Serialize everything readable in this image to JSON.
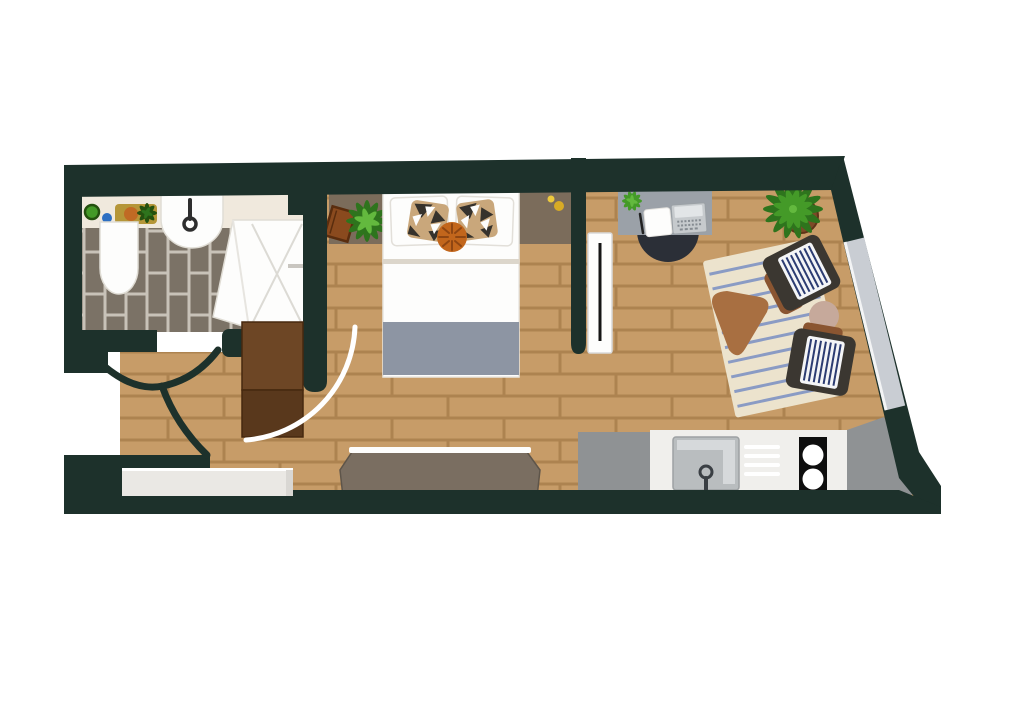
{
  "meta": {
    "title": "Studio apartment floor plan (top-down illustration)",
    "type": "floor-plan",
    "canvas_width": 1024,
    "canvas_height": 723
  },
  "colors": {
    "wall": "#1d312b",
    "floor_plank": "#c79c68",
    "floor_grout": "#ad8350",
    "bath_tile": "#7b7266",
    "bath_grout": "#c8c2b8",
    "counter_cream": "#f0e9dd",
    "white": "#fdfdfc",
    "fixture_stroke": "#e0ddd5",
    "headboard": "#7b6c5b",
    "blanket": "#8d95a3",
    "sheet_line": "#dcd6cb",
    "cushion_tan": "#c9a77b",
    "cushion_dark": "#36322c",
    "cushion_orange": "#c2661c",
    "cushion_orange_line": "#8f4612",
    "rug": "#ece3cd",
    "rug_stripe": "#8094c4",
    "chair_body": "#3b3731",
    "chair_pad": "#8a5531",
    "chair_cushion": "#f4f5f7",
    "chair_stripe": "#2c3c72",
    "coffee_table": "#a86f41",
    "side_table": "#c6a99b",
    "desk": "#9ba1a8",
    "laptop": "#c6cacd",
    "laptop_screen": "#e2e5e7",
    "laptop_key": "#858b91",
    "desk_chair": "#2b2f37",
    "radiator_line": "#151515",
    "window_glass": "#c9cdd3",
    "window_line": "#f3f4f5",
    "kitchen_gray": "#8f9294",
    "kitchen_white": "#f0efec",
    "sink_gray": "#b9bdbf",
    "sink_light": "#d7dadc",
    "faucet": "#3a3f44",
    "cooktop": "#0e0e0e",
    "bench": "#7a6e61",
    "bench_edge": "#5e554a",
    "mat": "#eae8e4",
    "door_top": "#6d4625",
    "door_bottom": "#59381c",
    "door_edge": "#46280f",
    "leaf_deep": "#24510f",
    "leaf_dark": "#2e741d",
    "leaf_mid": "#449a28",
    "leaf_light": "#63b93e",
    "pot": "#7c4a27",
    "pot_edge": "#5e3418",
    "tray": "#b59638",
    "tray_orange": "#c06a24",
    "dot_blue": "#2d6fc2",
    "dot_yellow_small": "#ecc93d",
    "dot_yellow_big": "#d8ab25",
    "book": "#8a4a1e",
    "book_edge": "#5a2d0e",
    "arc_white": "#ffffff"
  },
  "rooms": {
    "bathroom": {
      "items": [
        "vanity-counter",
        "toilet",
        "wash-basin",
        "shower-enclosure",
        "soap-pot",
        "blue-cup",
        "tray-with-plant",
        "tiled-floor"
      ]
    },
    "bedroom": {
      "items": [
        "double-bed",
        "pillow-left",
        "pillow-right",
        "patterned-cushion-left",
        "patterned-cushion-right",
        "round-orange-cushion",
        "gray-blanket",
        "headboard-shelf",
        "book",
        "plant-small",
        "wall-dots"
      ]
    },
    "workspace": {
      "items": [
        "desk",
        "laptop",
        "notepad",
        "pen",
        "desk-plant",
        "desk-chair"
      ]
    },
    "living": {
      "items": [
        "striped-rug",
        "armchair-top",
        "armchair-bottom",
        "coffee-table",
        "side-table",
        "large-potted-plant",
        "radiator",
        "window"
      ]
    },
    "kitchen": {
      "items": [
        "counter-gray-left",
        "counter-white",
        "kitchen-sink",
        "faucet",
        "drying-rack",
        "cooktop-two-burners",
        "counter-gray-angled"
      ]
    },
    "entry": {
      "items": [
        "entry-door-open",
        "door-swing-arc-white",
        "door-swing-arc-dark-1",
        "door-swing-arc-dark-2",
        "doormat",
        "storage-bench"
      ]
    }
  }
}
